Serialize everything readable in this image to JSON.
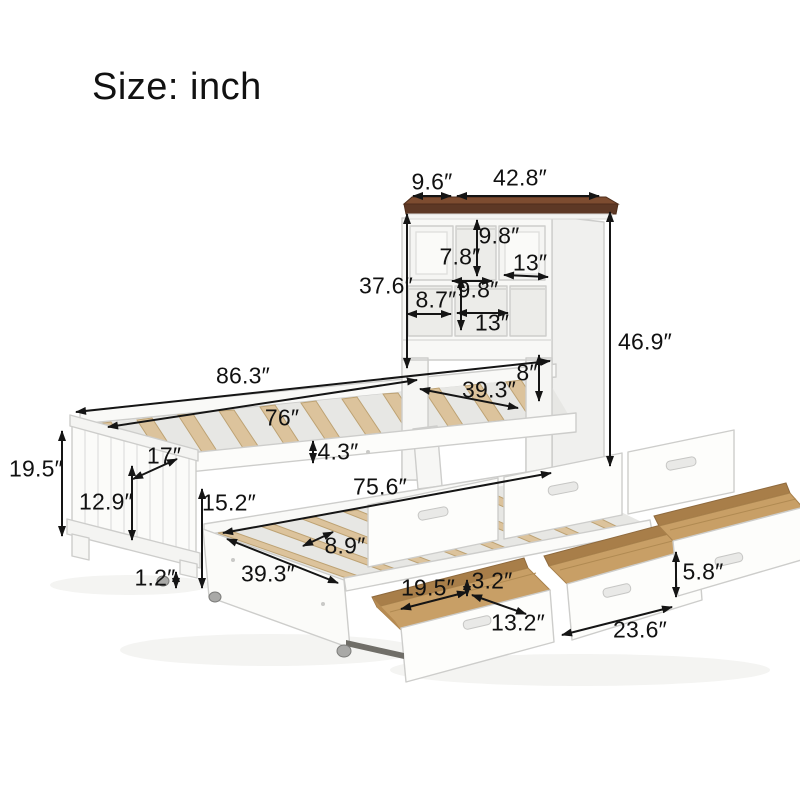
{
  "title": "Size: inch",
  "unit": "inch",
  "colors": {
    "background": "#ffffff",
    "text": "#111111",
    "dimension_line": "#151515",
    "headboard_wood_top": "#5d3825",
    "headboard_wood_top_face": "#7d4c30",
    "slat_wood": "#dcc39c",
    "drawer_interior_wood": "#c89f66",
    "furniture_white": "#fbfbf9",
    "furniture_stroke": "#cdcdcb"
  },
  "dims": {
    "headboard_top_depth": "9.6″",
    "headboard_top_width": "42.8″",
    "cubby_top_width": "7.8″",
    "cubby_top_height": "9.8″",
    "cubby_top_right_width": "13″",
    "cubby_left_width": "8.7″",
    "cubby_mid_height": "9.8″",
    "cubby_mid_width": "13″",
    "headboard_shelf_height": "37.6″",
    "headboard_total_height": "46.9″",
    "bed_total_length": "86.3″",
    "slat_length": "76″",
    "bed_width": "39.3″",
    "headboard_gap_height": "8″",
    "slat_rail_height": "4.3″",
    "footboard_depth": "17″",
    "foot_end_height": "19.5″",
    "footboard_panel_height": "12.9″",
    "floor_clearance": "1.2″",
    "trundle_height": "15.2″",
    "trundle_length": "75.6″",
    "slat_spacing": "8.9″",
    "trundle_width": "39.3″",
    "drawer_inner_length": "19.5″",
    "drawer_rail_gap": "3.2″",
    "drawer_inner_width": "13.2″",
    "drawer_front_length": "23.6″",
    "drawer_front_height": "5.8″"
  }
}
